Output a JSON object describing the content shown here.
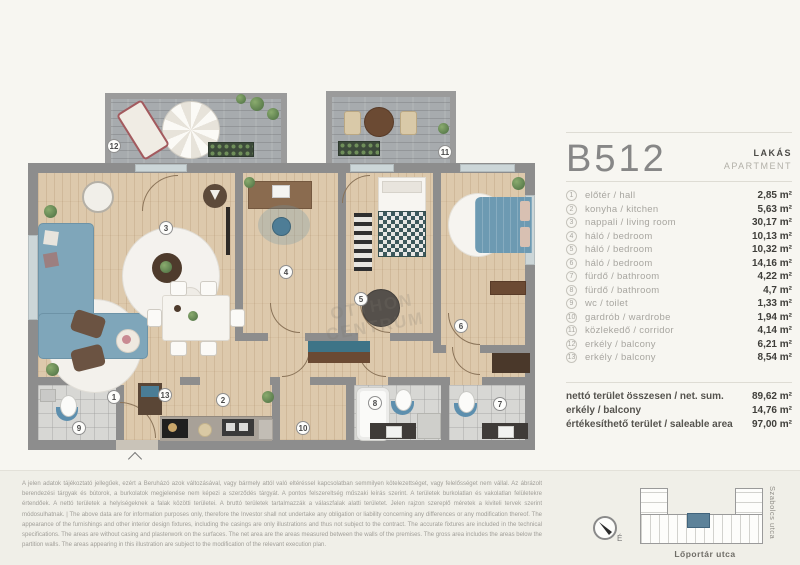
{
  "header": {
    "unit": "B512",
    "type_hu": "LAKÁS",
    "type_en": "APARTMENT"
  },
  "rooms": [
    {
      "num": "1",
      "label_hu": "előtér",
      "label_en": "hall",
      "area": "2,85 m²"
    },
    {
      "num": "2",
      "label_hu": "konyha",
      "label_en": "kitchen",
      "area": "5,63 m²"
    },
    {
      "num": "3",
      "label_hu": "nappali",
      "label_en": "living room",
      "area": "30,17 m²"
    },
    {
      "num": "4",
      "label_hu": "háló",
      "label_en": "bedroom",
      "area": "10,13 m²"
    },
    {
      "num": "5",
      "label_hu": "háló",
      "label_en": "bedroom",
      "area": "10,32 m²"
    },
    {
      "num": "6",
      "label_hu": "háló",
      "label_en": "bedroom",
      "area": "14,16 m²"
    },
    {
      "num": "7",
      "label_hu": "fürdő",
      "label_en": "bathroom",
      "area": "4,22 m²"
    },
    {
      "num": "8",
      "label_hu": "fürdő",
      "label_en": "bathroom",
      "area": "4,7 m²"
    },
    {
      "num": "9",
      "label_hu": "wc",
      "label_en": "toilet",
      "area": "1,33 m²"
    },
    {
      "num": "10",
      "label_hu": "gardrób",
      "label_en": "wardrobe",
      "area": "1,94 m²"
    },
    {
      "num": "11",
      "label_hu": "közlekedő",
      "label_en": "corridor",
      "area": "4,14 m²"
    },
    {
      "num": "12",
      "label_hu": "erkély",
      "label_en": "balcony",
      "area": "6,21 m²"
    },
    {
      "num": "13",
      "label_hu": "erkély",
      "label_en": "balcony",
      "area": "8,54 m²"
    }
  ],
  "totals": [
    {
      "label": "nettó terület összesen / net. sum.",
      "value": "89,62 m²"
    },
    {
      "label": "erkély / balcony",
      "value": "14,76 m²"
    },
    {
      "label": "értékesíthető terület / saleable area",
      "value": "97,00 m²"
    }
  ],
  "site_plan": {
    "street_right": "Szabolcs utca",
    "street_bottom": "Lőportár utca",
    "compass_label": "É"
  },
  "watermark": "OTTHON CENTRUM",
  "disclaimer": "A jelen adatok tájékoztató jellegűek, ezért a Beruházó azok változásával, vagy bármely attól való eltéréssel kapcsolatban semmilyen kötelezettséget, vagy felelősséget nem vállal. Az ábrázolt berendezési tárgyak és bútorok, a burkolatok megjelenése nem képezi a szerződés tárgyát. A pontos felszereltség műszaki leírás szerint. A területek burkolatlan és vakolatlan felületekre értendőek. A nettó területek a helyiségeknek a falak közötti területei. A bruttó területek tartalmazzák a válaszfalak alatti területet. Jelen rajzon szereplő méretek a kiviteli tervek szerint módosulhatnak. | The above data are for information purposes only, therefore the Investor shall not undertake any obligation or liability concerning any differences or any modification thereof. The appearance of the furnishings and other interior design fixtures, including the casings are only illustrations and thus not subject to the contract. The accurate fixtures are included in the technical specifications. The areas are without casing and plasterwork on the surfaces. The net area are the areas measured between the walls of the premises. The gross area includes the areas below the partition walls. The areas appearing in this illustration are subject to the modification of the relevant execution plan."
}
